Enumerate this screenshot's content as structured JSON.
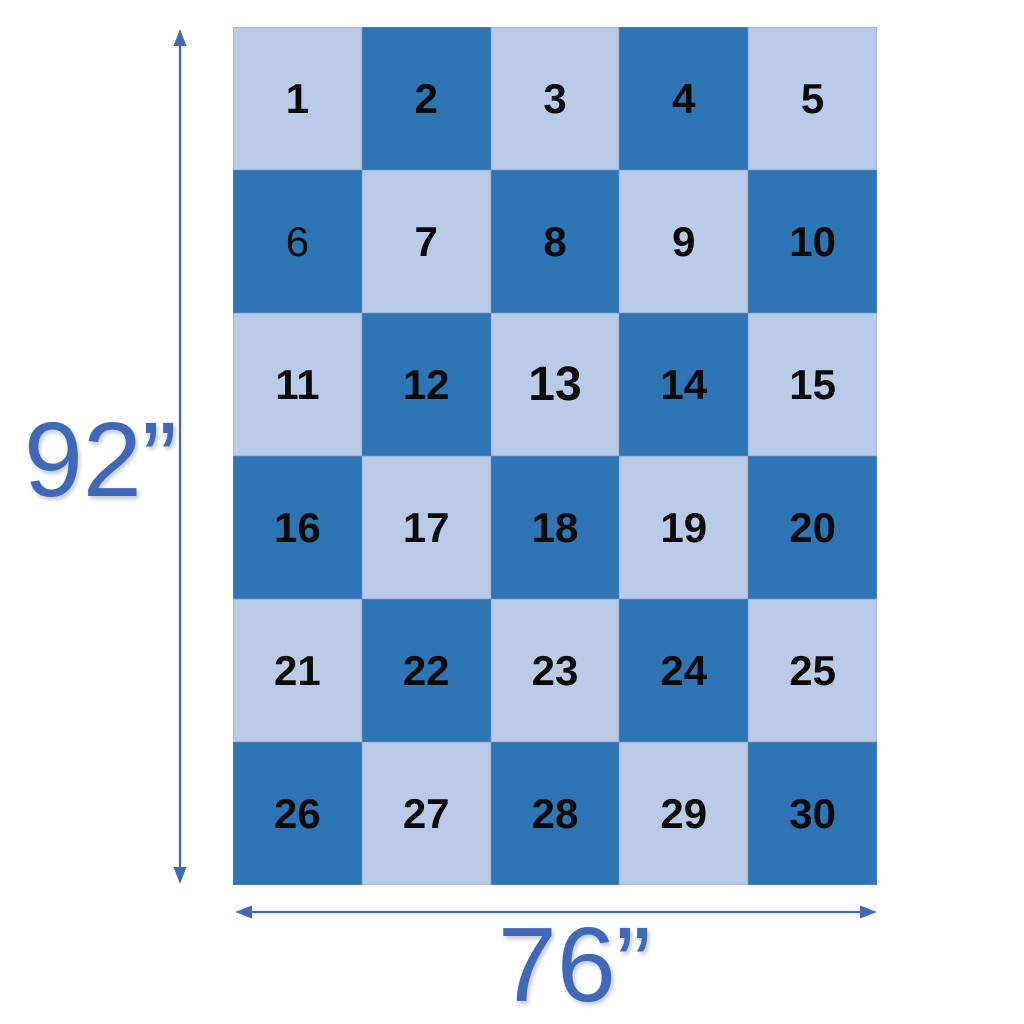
{
  "diagram": {
    "title_semantic": "quilt-layout-dimension-diagram",
    "height_label": "92”",
    "width_label": "76”",
    "colors": {
      "dark_cell": "#2e75b6",
      "light_cell": "#b9cbe9",
      "number": "#0a0a0a",
      "dimension_text": "#4068b8",
      "arrow": "#4169b4"
    },
    "grid": {
      "rows": 6,
      "cols": 5,
      "cells": [
        {
          "label": "1",
          "shade": "light"
        },
        {
          "label": "2",
          "shade": "dark"
        },
        {
          "label": "3",
          "shade": "light"
        },
        {
          "label": "4",
          "shade": "dark"
        },
        {
          "label": "5",
          "shade": "light"
        },
        {
          "label": "6",
          "shade": "dark",
          "variant": "thin"
        },
        {
          "label": "7",
          "shade": "light"
        },
        {
          "label": "8",
          "shade": "dark"
        },
        {
          "label": "9",
          "shade": "light"
        },
        {
          "label": "10",
          "shade": "dark"
        },
        {
          "label": "11",
          "shade": "light"
        },
        {
          "label": "12",
          "shade": "dark"
        },
        {
          "label": "13",
          "shade": "light",
          "variant": "large"
        },
        {
          "label": "14",
          "shade": "dark"
        },
        {
          "label": "15",
          "shade": "light"
        },
        {
          "label": "16",
          "shade": "dark"
        },
        {
          "label": "17",
          "shade": "light"
        },
        {
          "label": "18",
          "shade": "dark"
        },
        {
          "label": "19",
          "shade": "light"
        },
        {
          "label": "20",
          "shade": "dark"
        },
        {
          "label": "21",
          "shade": "light"
        },
        {
          "label": "22",
          "shade": "dark"
        },
        {
          "label": "23",
          "shade": "light"
        },
        {
          "label": "24",
          "shade": "dark"
        },
        {
          "label": "25",
          "shade": "light"
        },
        {
          "label": "26",
          "shade": "dark"
        },
        {
          "label": "27",
          "shade": "light"
        },
        {
          "label": "28",
          "shade": "dark"
        },
        {
          "label": "29",
          "shade": "light"
        },
        {
          "label": "30",
          "shade": "dark"
        }
      ]
    }
  }
}
